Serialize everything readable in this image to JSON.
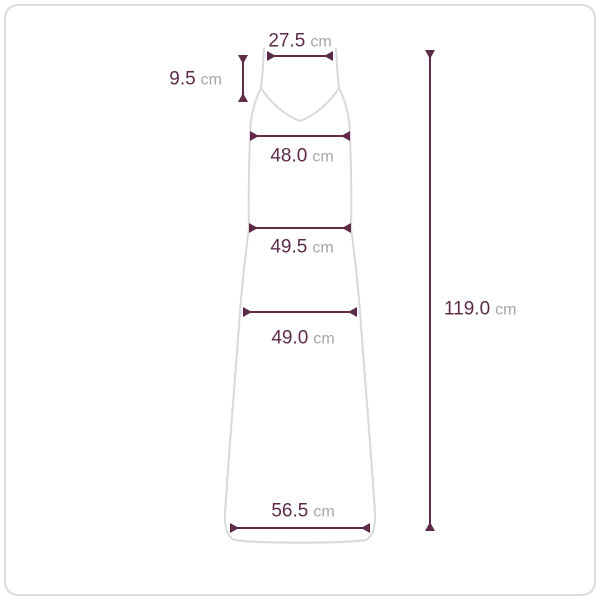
{
  "measurements": {
    "top_width": {
      "value": "27.5",
      "unit": "cm"
    },
    "strap_drop": {
      "value": "9.5",
      "unit": "cm"
    },
    "bust_width": {
      "value": "48.0",
      "unit": "cm"
    },
    "waist_width": {
      "value": "49.5",
      "unit": "cm"
    },
    "hip_width": {
      "value": "49.0",
      "unit": "cm"
    },
    "hem_width": {
      "value": "56.5",
      "unit": "cm"
    },
    "total_length": {
      "value": "119.0",
      "unit": "cm"
    }
  },
  "colors": {
    "measure_accent": "#5e2b49",
    "value_text": "#5e2b49",
    "unit_text": "#a6a6a6",
    "garment_outline": "#d9d9d9",
    "card_border": "#dcdcdc",
    "background": "#ffffff"
  }
}
